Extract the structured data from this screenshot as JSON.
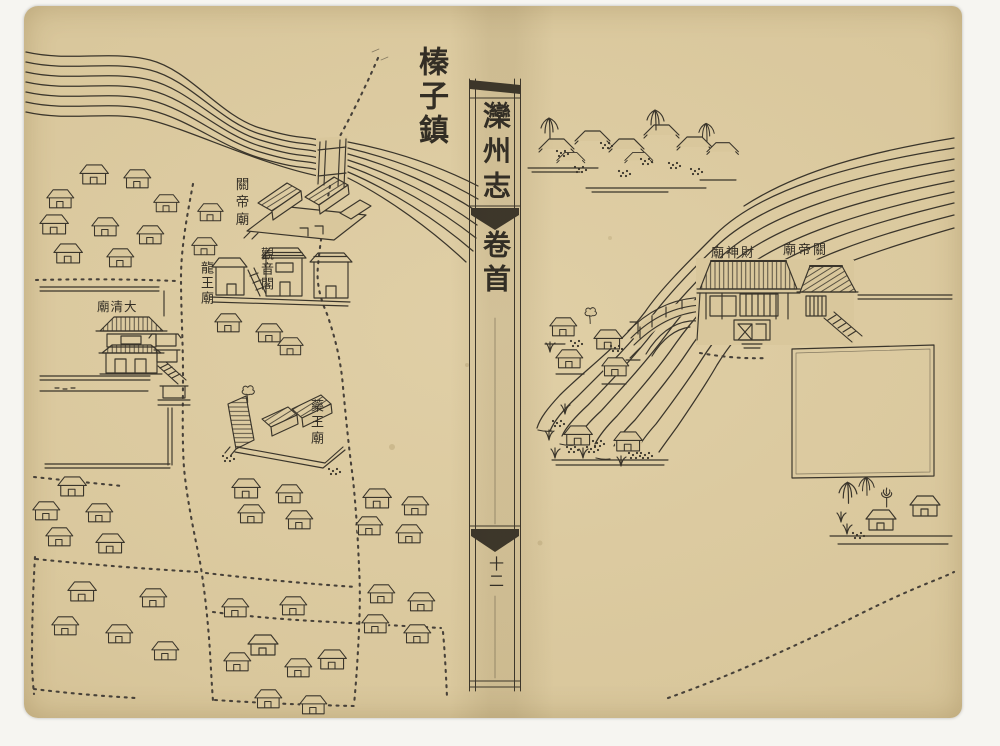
{
  "document": {
    "left_page": {
      "title": "榛子鎮",
      "temple_labels": [
        {
          "id": "guandi-temple",
          "text": "關帝廟",
          "orientation": "vertical"
        },
        {
          "id": "longwang-temple",
          "text": "龍王廟",
          "orientation": "vertical"
        },
        {
          "id": "guanyin-pavilion",
          "text": "觀音閣",
          "orientation": "vertical"
        },
        {
          "id": "daqing-temple",
          "text": "大清廟",
          "orientation": "horizontal-right-to-left"
        },
        {
          "id": "yaowang-temple",
          "text": "藥王廟",
          "orientation": "vertical"
        }
      ]
    },
    "spine": {
      "book_title": "灤州志",
      "section_title": "卷首",
      "page_number": "十二"
    },
    "right_page": {
      "temple_labels": [
        {
          "id": "caishen-temple",
          "text": "財神廟",
          "orientation": "horizontal-right-to-left"
        },
        {
          "id": "guandi-temple-right",
          "text": "關帝廟",
          "orientation": "horizontal-right-to-left"
        }
      ]
    }
  },
  "colors": {
    "paper": "#d9c79c",
    "ink": "#3a352b",
    "margin": "#f6f5f1"
  }
}
